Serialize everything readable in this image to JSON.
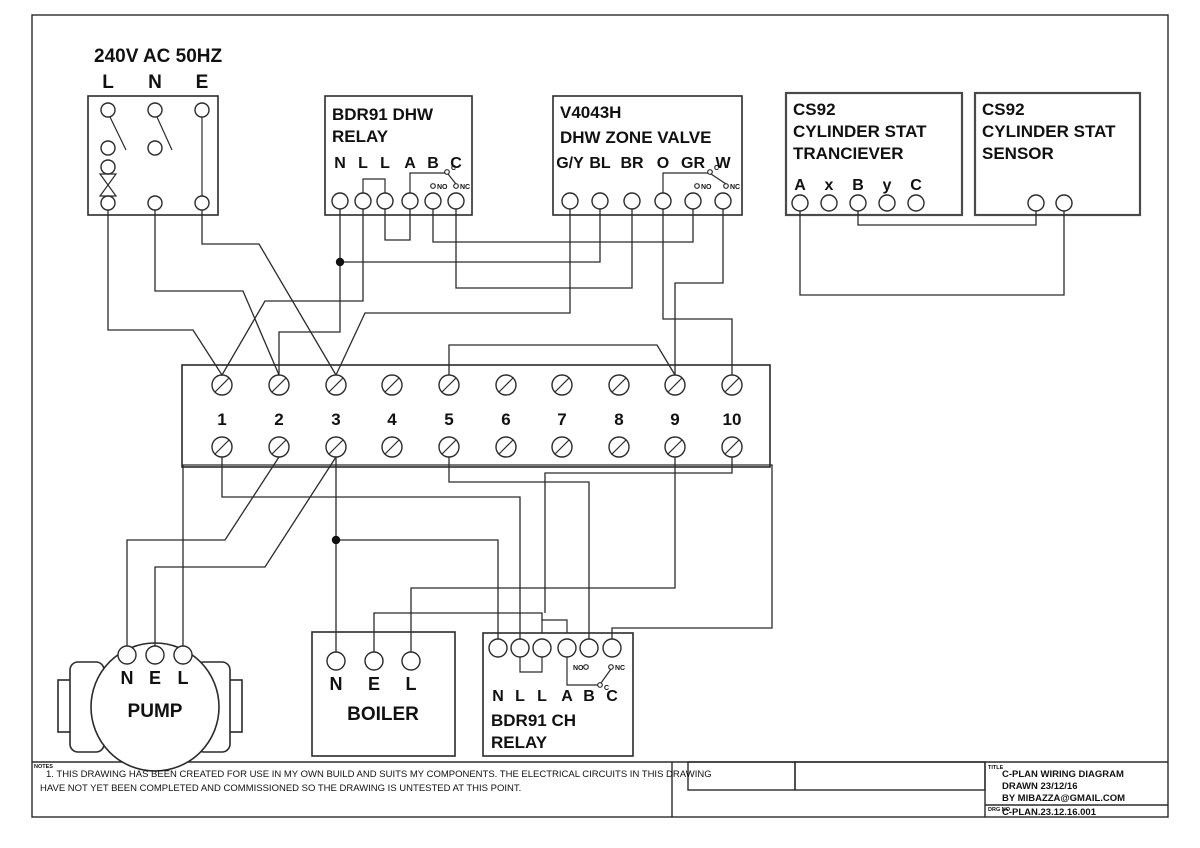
{
  "page": {
    "background": "#ffffff",
    "line_color": "#2b2b2b"
  },
  "components": {
    "mains": {
      "title": "240V AC 50HZ",
      "terminals": [
        "L",
        "N",
        "E"
      ]
    },
    "dhw_relay": {
      "title1": "BDR91 DHW",
      "title2": "RELAY",
      "terminals": [
        "N",
        "L",
        "L",
        "A",
        "B",
        "C"
      ],
      "switch": {
        "c": "C",
        "no": "NO",
        "nc": "NC"
      }
    },
    "zone_valve": {
      "title1": "V4043H",
      "title2": "DHW ZONE VALVE",
      "terminals": [
        "G/Y",
        "BL",
        "BR",
        "O",
        "GR",
        "W"
      ],
      "switch": {
        "c": "C",
        "no": "NO",
        "nc": "NC"
      }
    },
    "cs92_transceiver": {
      "title1": "CS92",
      "title2": "CYLINDER STAT",
      "title3": "TRANCIEVER",
      "terminals": [
        "A",
        "x",
        "B",
        "y",
        "C"
      ]
    },
    "cs92_sensor": {
      "title1": "CS92",
      "title2": "CYLINDER STAT",
      "title3": "SENSOR"
    },
    "terminal_strip": {
      "numbers": [
        "1",
        "2",
        "3",
        "4",
        "5",
        "6",
        "7",
        "8",
        "9",
        "10"
      ],
      "xs": [
        222,
        279,
        336,
        392,
        449,
        506,
        562,
        619,
        675,
        732
      ],
      "top_y": 385,
      "bottom_y": 447,
      "number_baseline_y": 425
    },
    "pump": {
      "label": "PUMP",
      "terminals": [
        "N",
        "E",
        "L"
      ]
    },
    "boiler": {
      "label": "BOILER",
      "terminals": [
        "N",
        "E",
        "L"
      ]
    },
    "ch_relay": {
      "title1": "BDR91 CH",
      "title2": "RELAY",
      "terminals": [
        "N",
        "L",
        "L",
        "A",
        "B",
        "C"
      ],
      "switch": {
        "c": "C",
        "no": "NO",
        "nc": "NC"
      }
    }
  },
  "wires": [
    {
      "from": "mains-L",
      "to": "strip-1-top",
      "points": [
        [
          108,
          210
        ],
        [
          108,
          330
        ],
        [
          193,
          330
        ],
        [
          222,
          375
        ]
      ]
    },
    {
      "from": "mains-N",
      "to": "strip-2-top",
      "points": [
        [
          155,
          210
        ],
        [
          155,
          291
        ],
        [
          243,
          291
        ],
        [
          279,
          375
        ]
      ]
    },
    {
      "from": "mains-E",
      "to": "strip-3-top",
      "points": [
        [
          202,
          210
        ],
        [
          202,
          244
        ],
        [
          259,
          244
        ],
        [
          336,
          375
        ]
      ]
    },
    {
      "from": "dhw-relay-N",
      "to": "strip-2-top",
      "points": [
        [
          340,
          209
        ],
        [
          340,
          332
        ],
        [
          279,
          332
        ],
        [
          279,
          375
        ]
      ]
    },
    {
      "from": "dhw-relay-N-junction",
      "to": "valve-BL",
      "points": [
        [
          340,
          262
        ],
        [
          600,
          262
        ],
        [
          600,
          209
        ]
      ]
    },
    {
      "from": "dhw-relay-L1",
      "to": "strip-1-top",
      "points": [
        [
          363,
          209
        ],
        [
          363,
          301
        ],
        [
          265,
          301
        ],
        [
          222,
          375
        ]
      ]
    },
    {
      "from": "dhw-relay-L2",
      "to": "dhw-relay-A",
      "points": [
        [
          385,
          209
        ],
        [
          385,
          240
        ],
        [
          410,
          240
        ],
        [
          410,
          209
        ]
      ]
    },
    {
      "from": "dhw-relay-B",
      "to": "valve-GR",
      "points": [
        [
          433,
          209
        ],
        [
          433,
          242
        ],
        [
          693,
          242
        ],
        [
          693,
          209
        ]
      ]
    },
    {
      "from": "dhw-relay-C",
      "to": "valve-BR",
      "points": [
        [
          456,
          209
        ],
        [
          456,
          288
        ],
        [
          632,
          288
        ],
        [
          632,
          209
        ]
      ]
    },
    {
      "from": "valve-GY",
      "to": "strip-3-top",
      "points": [
        [
          570,
          209
        ],
        [
          570,
          313
        ],
        [
          365,
          313
        ],
        [
          336,
          375
        ]
      ]
    },
    {
      "from": "valve-O",
      "to": "strip-10-top",
      "points": [
        [
          663,
          209
        ],
        [
          663,
          319
        ],
        [
          732,
          319
        ],
        [
          732,
          375
        ]
      ]
    },
    {
      "from": "valve-W",
      "to": "strip-9-top",
      "points": [
        [
          723,
          209
        ],
        [
          723,
          283
        ],
        [
          675,
          283
        ],
        [
          675,
          375
        ]
      ]
    },
    {
      "from": "strip-5-top",
      "to": "strip-9-top",
      "points": [
        [
          449,
          375
        ],
        [
          449,
          345
        ],
        [
          657,
          345
        ],
        [
          675,
          375
        ]
      ]
    },
    {
      "from": "cs92-A",
      "to": "sensor-right",
      "points": [
        [
          800,
          211
        ],
        [
          800,
          295
        ],
        [
          1064,
          295
        ],
        [
          1064,
          211
        ]
      ]
    },
    {
      "from": "cs92-B",
      "to": "sensor-left",
      "points": [
        [
          858,
          211
        ],
        [
          858,
          225
        ],
        [
          1036,
          225
        ],
        [
          1036,
          211
        ]
      ]
    },
    {
      "from": "strip-2-bottom",
      "to": "pump-N",
      "points": [
        [
          279,
          457
        ],
        [
          225,
          540
        ],
        [
          127,
          540
        ],
        [
          127,
          646
        ]
      ]
    },
    {
      "from": "strip-3-bottom",
      "to": "pump-E",
      "points": [
        [
          336,
          457
        ],
        [
          265,
          567
        ],
        [
          155,
          567
        ],
        [
          155,
          646
        ]
      ]
    },
    {
      "from": "pump-L",
      "to": "ch-relay-C",
      "points": [
        [
          183,
          646
        ],
        [
          183,
          465
        ],
        [
          772,
          465
        ],
        [
          772,
          628
        ],
        [
          612,
          628
        ],
        [
          612,
          639
        ]
      ]
    },
    {
      "from": "strip-1-bottom",
      "to": "ch-relay-L1",
      "points": [
        [
          222,
          457
        ],
        [
          222,
          497
        ],
        [
          520,
          497
        ],
        [
          520,
          639
        ]
      ]
    },
    {
      "from": "strip-3-bottom",
      "to": "boiler-N",
      "points": [
        [
          336,
          457
        ],
        [
          336,
          652
        ]
      ]
    },
    {
      "from": "neutral-junction",
      "to": "ch-relay-N",
      "points": [
        [
          336,
          540
        ],
        [
          498,
          540
        ],
        [
          498,
          639
        ]
      ]
    },
    {
      "from": "boiler-E",
      "to": "ch-relay-jumper",
      "points": [
        [
          374,
          652
        ],
        [
          374,
          613
        ],
        [
          542,
          613
        ],
        [
          542,
          621
        ]
      ]
    },
    {
      "from": "strip-9-bottom",
      "to": "boiler-L",
      "points": [
        [
          675,
          457
        ],
        [
          675,
          588
        ],
        [
          411,
          588
        ],
        [
          411,
          652
        ]
      ]
    },
    {
      "from": "strip-5-bottom",
      "to": "ch-relay-B",
      "points": [
        [
          449,
          457
        ],
        [
          449,
          482
        ],
        [
          589,
          482
        ],
        [
          589,
          639
        ]
      ]
    },
    {
      "from": "strip-10-bottom",
      "to": "ch-relay-jumper",
      "points": [
        [
          732,
          457
        ],
        [
          732,
          473
        ],
        [
          545,
          473
        ],
        [
          545,
          613
        ]
      ]
    }
  ],
  "junctions": [
    [
      340,
      262
    ],
    [
      336,
      540
    ]
  ],
  "notes": {
    "section_label": "NOTES",
    "line1": "1. THIS DRAWING HAS BEEN CREATED FOR USE IN MY OWN  BUILD AND SUITS MY COMPONENTS.  THE ELECTRICAL CIRCUITS IN THIS DRAWING",
    "line2": "HAVE NOT YET BEEN COMPLETED AND COMMISSIONED SO THE DRAWING IS UNTESTED AT THIS POINT."
  },
  "title_block": {
    "title_label": "TITLE",
    "title_line1": "C-PLAN WIRING DIAGRAM",
    "title_line2": "DRAWN 23/12/16",
    "title_line3": "BY MIBAZZA@GMAIL.COM",
    "drg_label": "DRG NO",
    "drg_no": "C-PLAN.23.12.16.001"
  }
}
